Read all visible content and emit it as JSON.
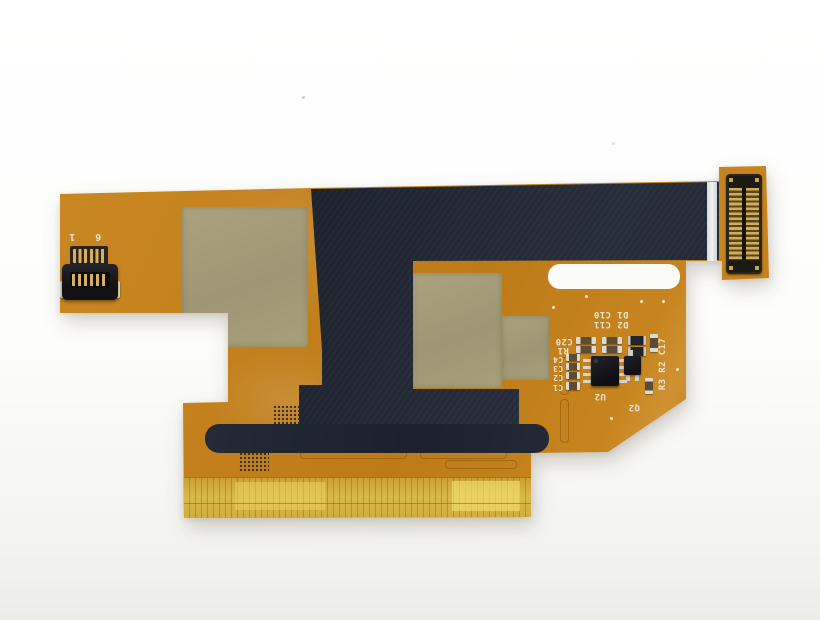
{
  "meta": {
    "subject": "Orange flexible printed circuit (LCD flex ribbon cable) photographed on a white background",
    "orientation_note": "silkscreen text printed upside-down relative to photo"
  },
  "colors": {
    "background": "#fbfbfa",
    "flex_orange": "#c5821d",
    "coverlay_black": "#20252f",
    "stiffener_khaki": "#a49c78",
    "contact_gold": "#d4ad55",
    "translucent_contact_yellow": "#d9b84a",
    "silkscreen_white": "#ebe3d4",
    "alignment_stripe_white": "#eef0f2"
  },
  "left_connector": {
    "marking_pin1": "1",
    "marking_pin6": "6",
    "pin_count": 6
  },
  "right_connector": {
    "pin_columns": 2,
    "pins_per_column": 15
  },
  "silkscreen": {
    "row1": "D1 C10",
    "row2": "D2 C11",
    "c20": "C20",
    "r1": "R1",
    "cap_column": [
      "C4",
      "C3",
      "C2",
      "C1"
    ],
    "u2": "U2",
    "q2": "Q2",
    "side_labels": "R3 R2 C17"
  }
}
